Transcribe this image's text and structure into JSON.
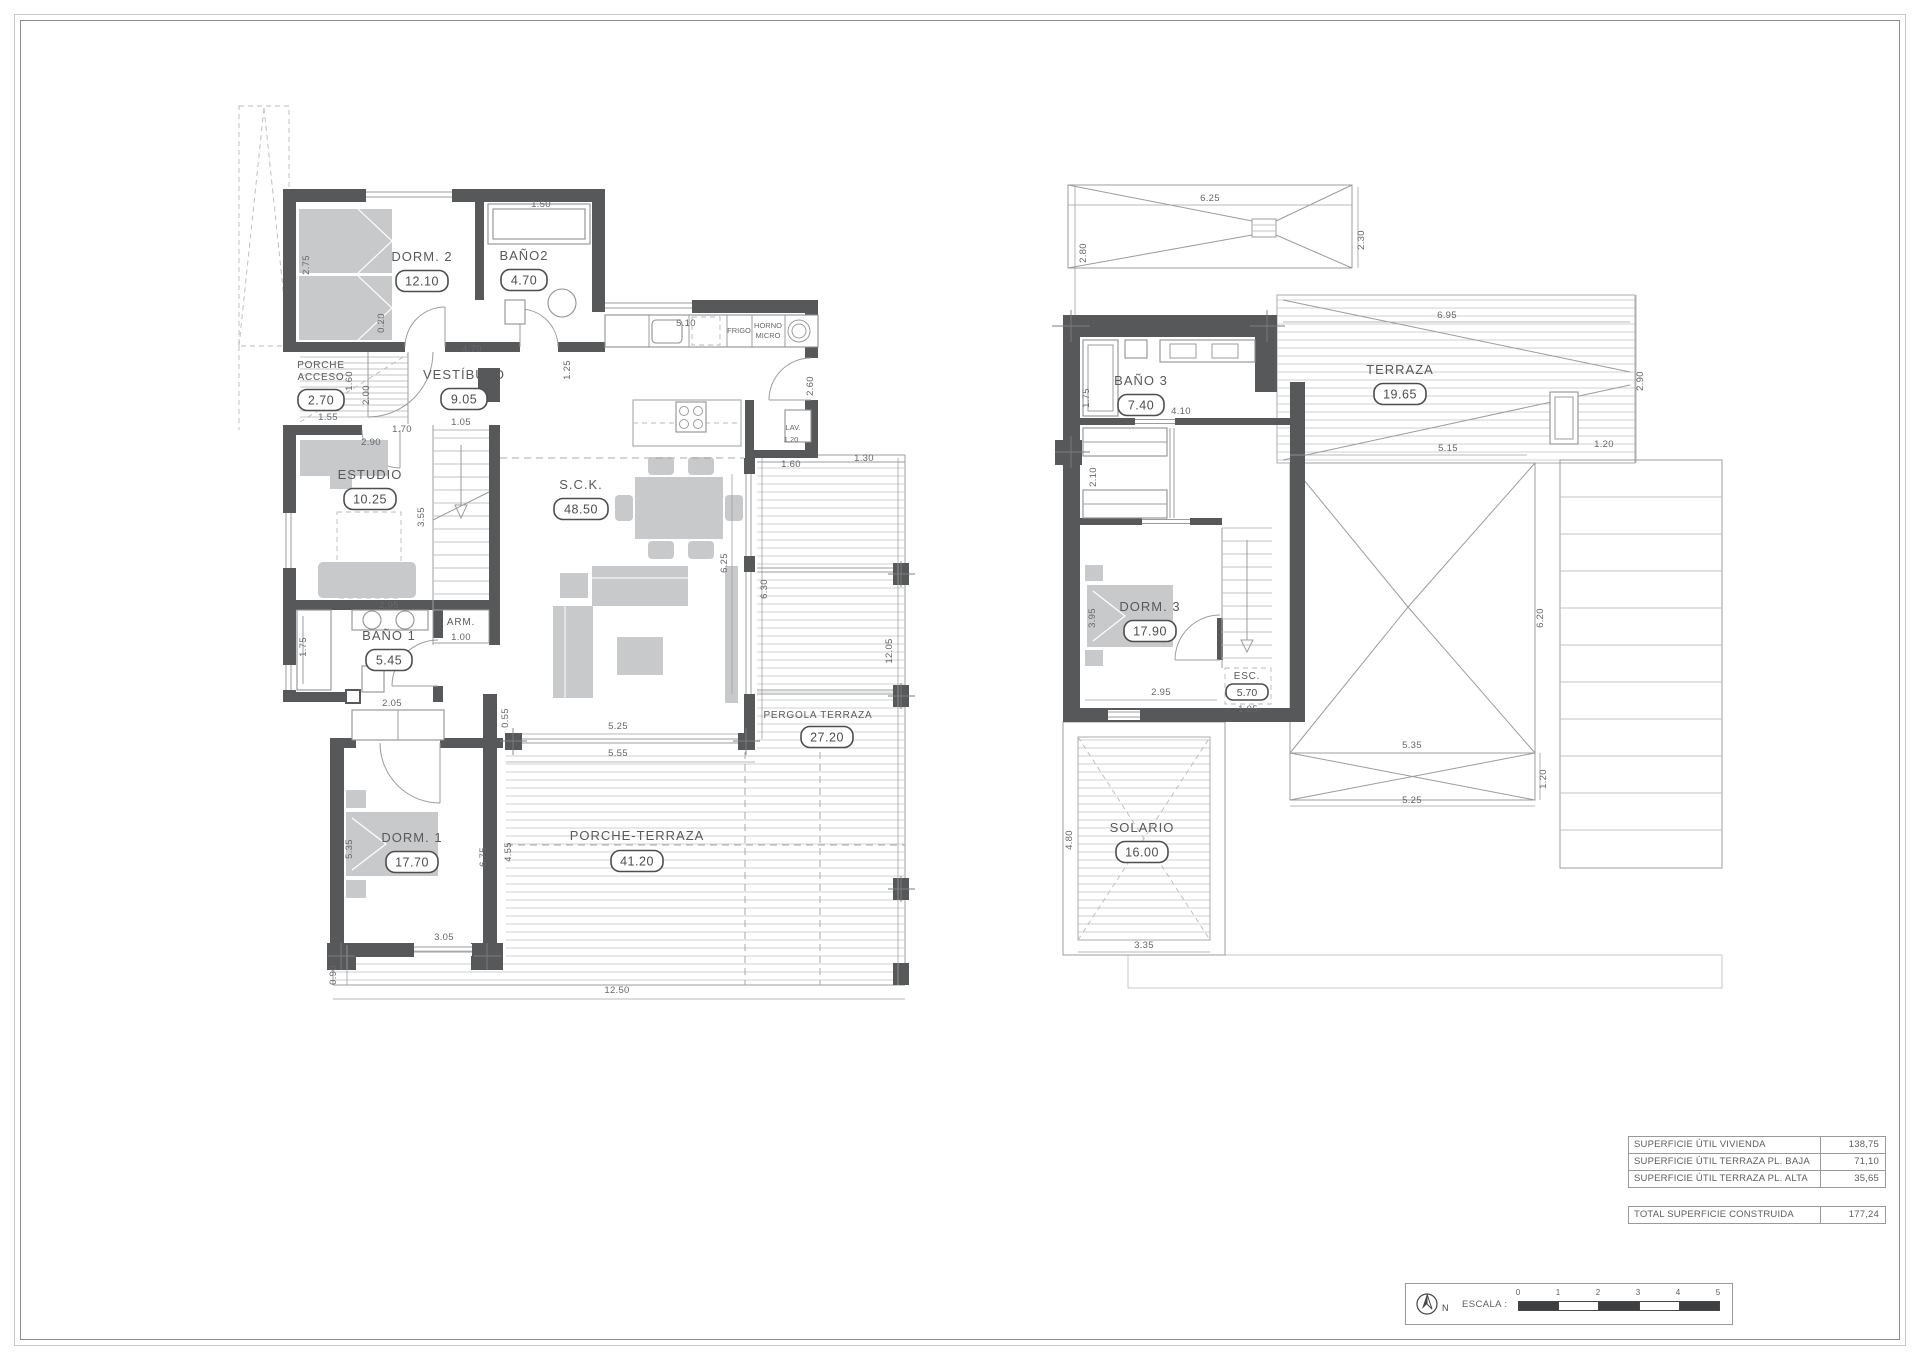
{
  "ground_floor": {
    "rooms": [
      {
        "name": "DORM. 2",
        "area": "12.10"
      },
      {
        "name": "BAÑO2",
        "area": "4.70"
      },
      {
        "name": "VESTÍBULO",
        "area": "9.05"
      },
      {
        "line1": "PORCHE",
        "line2": "ACCESO",
        "area": "2.70"
      },
      {
        "name": "ESTUDIO",
        "area": "10.25"
      },
      {
        "name": "BAÑO 1",
        "area": "5.45"
      },
      {
        "name": "DORM. 1",
        "area": "17.70"
      },
      {
        "name": "S.C.K.",
        "area": "48.50"
      },
      {
        "name": "LAV.",
        "area": "1.20"
      },
      {
        "name": "ARM."
      },
      {
        "name": "PERGOLA TERRAZA",
        "area": "27.20"
      },
      {
        "name": "PORCHE-TERRAZA",
        "area": "41.20"
      }
    ],
    "appliances": {
      "fridge": "FRIGO",
      "oven": "HORNO",
      "micro": "MICRO"
    },
    "dims": [
      "1.50",
      "2.75",
      "0.20",
      "4.70",
      "5.10",
      "1.25",
      "2.60",
      "1.60",
      "1.30",
      "1.55",
      "1.70",
      "2.00",
      "1.60",
      "1.05",
      "2.90",
      "3.55",
      "1.00",
      "2.95",
      "1.75",
      "2.05",
      "0.55",
      "5.25",
      "5.55",
      "6.25",
      "6.30",
      "12.05",
      "5.35",
      "6.75",
      "4.55",
      "3.05",
      "0.90",
      "12.50"
    ]
  },
  "upper_floor": {
    "rooms": [
      {
        "name": "BAÑO 3",
        "area": "7.40"
      },
      {
        "name": "TERRAZA",
        "area": "19.65"
      },
      {
        "name": "DORM. 3",
        "area": "17.90"
      },
      {
        "name": "ESC.",
        "area": "5.70"
      },
      {
        "name": "SOLARIO",
        "area": "16.00"
      }
    ],
    "dims": [
      "6.25",
      "2.80",
      "2.30",
      "6.95",
      "2.90",
      "1.75",
      "4.10",
      "2.10",
      "5.15",
      "1.20",
      "3.95",
      "2.95",
      "1.05",
      "6.20",
      "5.35",
      "5.25",
      "1.20",
      "4.80",
      "3.35"
    ]
  },
  "summary_table": {
    "rows": [
      {
        "label": "SUPERFICIE ÚTIL VIVIENDA",
        "value": "138,75"
      },
      {
        "label": "SUPERFICIE ÚTIL TERRAZA PL. BAJA",
        "value": "71,10"
      },
      {
        "label": "SUPERFICIE ÚTIL TERRAZA PL. ALTA",
        "value": "35,65"
      }
    ],
    "total": {
      "label": "TOTAL SUPERFICIE CONSTRUIDA",
      "value": "177,24"
    }
  },
  "scale_bar": {
    "label": "ESCALA :",
    "north": "N",
    "ticks": [
      "0",
      "1",
      "2",
      "3",
      "4",
      "5"
    ]
  }
}
